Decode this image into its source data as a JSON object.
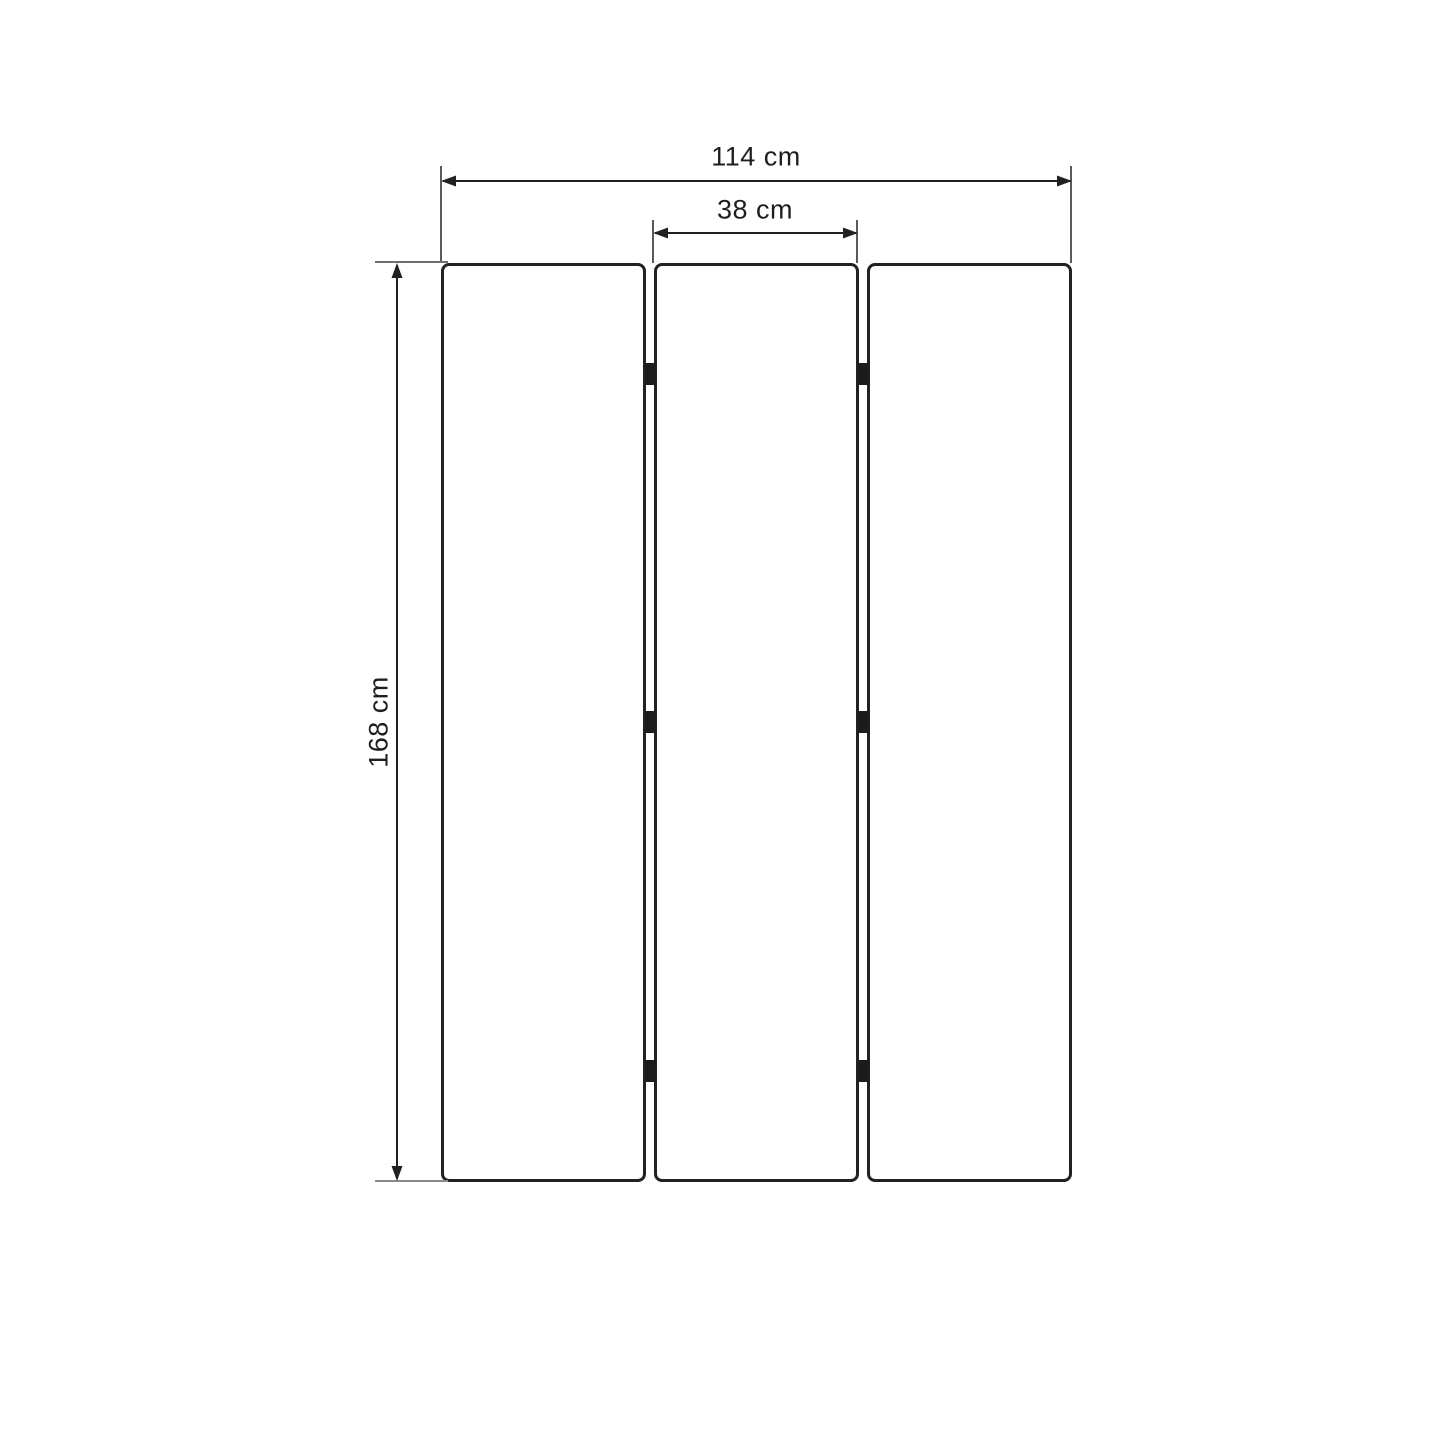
{
  "diagram": {
    "measurements": {
      "total_width": "114 cm",
      "panel_width": "38 cm",
      "height": "168 cm"
    },
    "structure": {
      "panel_count": 3,
      "hinge_rows": 3,
      "hinge_columns": 2
    },
    "colors": {
      "background": "#ffffff",
      "panel_border": "#222222",
      "panel_fill": "#ffffff",
      "dimension_line": "#212121",
      "extension_line": "#5a5a5a",
      "hinge": "#1c1c1c",
      "label_text": "#1e1e1e"
    }
  }
}
